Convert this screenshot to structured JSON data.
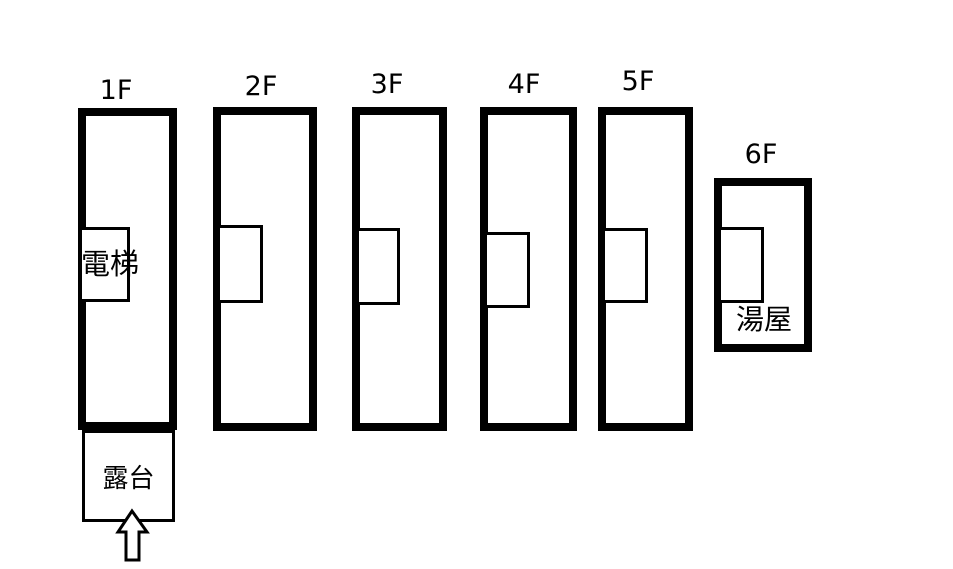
{
  "diagram": {
    "description": "Six-storey building stacking plan with elevator shaft, roof terrace and bathhouse",
    "floors": [
      {
        "label": "1F",
        "room_label": "電梯"
      },
      {
        "label": "2F",
        "room_label": ""
      },
      {
        "label": "3F",
        "room_label": ""
      },
      {
        "label": "4F",
        "room_label": ""
      },
      {
        "label": "5F",
        "room_label": ""
      },
      {
        "label": "6F",
        "room_label": "湯屋"
      }
    ],
    "terrace_label": "露台",
    "entrance_arrow": {
      "direction": "up"
    },
    "colors": {
      "line": "#000000",
      "background": "#ffffff"
    }
  }
}
